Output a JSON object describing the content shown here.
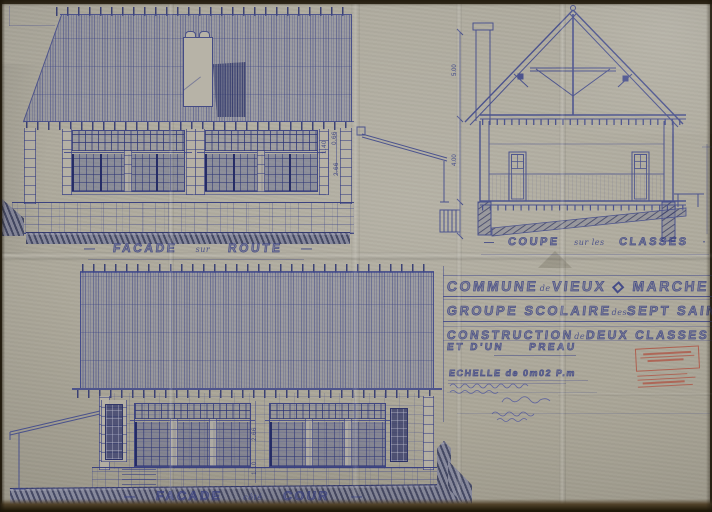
{
  "colors": {
    "paper": "#b2aea0",
    "ink": "#3e4688",
    "stamp_red": "#b04a3a"
  },
  "labels": {
    "facade_route": {
      "dash_left": "—",
      "main_1": "FACADE",
      "small": "sur",
      "main_2": "ROUTE",
      "dash_right": "—"
    },
    "coupe_classes": {
      "dash_left": "—",
      "main_1": "COUPE",
      "small": "sur les",
      "main_2": "CLASSES",
      "dash_right": "·"
    },
    "facade_cour": {
      "dash_left": "—",
      "main_1": "FACADE",
      "small": "côté",
      "main_2": "COUR",
      "dash_right": "—"
    }
  },
  "title_block": {
    "line1": {
      "main_1": "COMMUNE",
      "small": "de",
      "main_2": "VIEUX ◇ MARCHE"
    },
    "line2": {
      "main_1": "GROUPE SCOLAIRE",
      "small": "des",
      "main_2": "SEPT SAINTS"
    },
    "line3": {
      "main_1": "CONSTRUCTION",
      "small": "de",
      "main_2": "DEUX CLASSES"
    },
    "line4": {
      "main_1": "ET D'UN",
      "main_2": "PREAU"
    },
    "scale_line": "ECHELLE de 0m02 P.m"
  },
  "dimensions": {
    "elev_route": [
      "1.40",
      "0.66",
      "2.66"
    ],
    "coupe": [
      "5.00",
      "4.00"
    ],
    "elev_cour": [
      "2.66",
      "1.10"
    ]
  }
}
